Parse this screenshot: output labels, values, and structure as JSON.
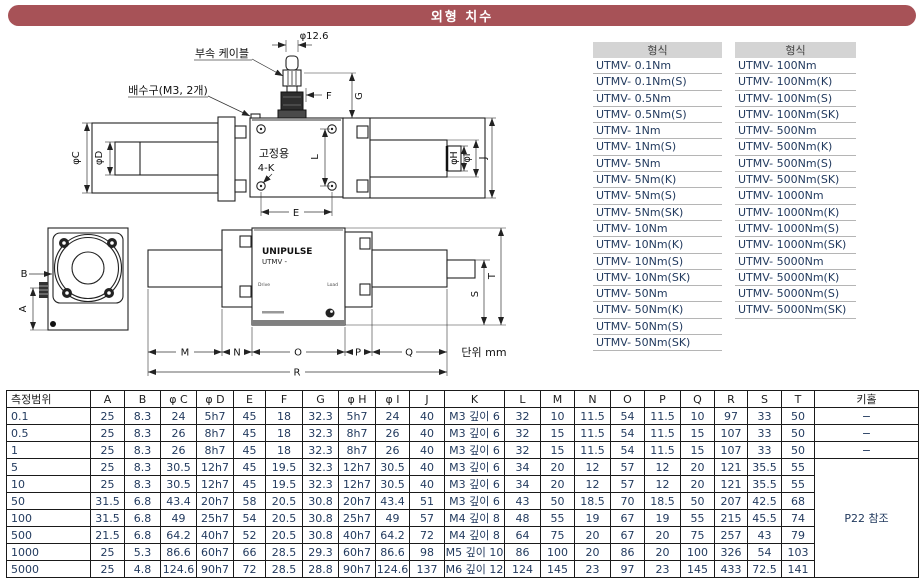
{
  "title": "외형 치수",
  "diagram": {
    "labels": {
      "cable": "부속 케이블",
      "cable_dia": "φ12.6",
      "drain": "배수구(M3, 2개)",
      "fixing_l1": "고정용",
      "fixing_l2": "4-K",
      "unit": "단위 mm"
    },
    "device": {
      "brand": "UNIPULSE",
      "model": "UTMV -",
      "left_label": "Drive",
      "right_label": "Load"
    },
    "dims": {
      "a": "A",
      "b": "B",
      "phi_c": "φC",
      "phi_d": "φD",
      "e": "E",
      "f": "F",
      "g": "G",
      "phi_h": "φH",
      "phi_i": "φI",
      "j": "J",
      "l": "L",
      "m": "M",
      "n": "N",
      "o": "O",
      "p": "P",
      "q": "Q",
      "r": "R",
      "s": "S",
      "t": "T"
    }
  },
  "model_lists": [
    {
      "header": "형식",
      "items": [
        "UTMV- 0.1Nm",
        "UTMV- 0.1Nm(S)",
        "UTMV- 0.5Nm",
        "UTMV- 0.5Nm(S)",
        "UTMV- 1Nm",
        "UTMV- 1Nm(S)",
        "UTMV- 5Nm",
        "UTMV- 5Nm(K)",
        "UTMV- 5Nm(S)",
        "UTMV- 5Nm(SK)",
        "UTMV- 10Nm",
        "UTMV- 10Nm(K)",
        "UTMV- 10Nm(S)",
        "UTMV- 10Nm(SK)",
        "UTMV- 50Nm",
        "UTMV- 50Nm(K)",
        "UTMV- 50Nm(S)",
        "UTMV- 50Nm(SK)"
      ]
    },
    {
      "header": "형식",
      "items": [
        "UTMV- 100Nm",
        "UTMV- 100Nm(K)",
        "UTMV- 100Nm(S)",
        "UTMV- 100Nm(SK)",
        "UTMV- 500Nm",
        "UTMV- 500Nm(K)",
        "UTMV- 500Nm(S)",
        "UTMV- 500Nm(SK)",
        "UTMV- 1000Nm",
        "UTMV- 1000Nm(K)",
        "UTMV- 1000Nm(S)",
        "UTMV- 1000Nm(SK)",
        "UTMV- 5000Nm",
        "UTMV- 5000Nm(K)",
        "UTMV- 5000Nm(S)",
        "UTMV- 5000Nm(SK)"
      ]
    }
  ],
  "table": {
    "headers": [
      "측정범위",
      "A",
      "B",
      "φ C",
      "φ D",
      "E",
      "F",
      "G",
      "φ H",
      "φ I",
      "J",
      "K",
      "L",
      "M",
      "N",
      "O",
      "P",
      "Q",
      "R",
      "S",
      "T",
      "키홀"
    ],
    "rows": [
      {
        "range": "0.1",
        "values": [
          "25",
          "8.3",
          "24",
          "5h7",
          "45",
          "18",
          "32.3",
          "5h7",
          "24",
          "40",
          "M3 깊이 6",
          "32",
          "10",
          "11.5",
          "54",
          "11.5",
          "10",
          "97",
          "33",
          "50"
        ],
        "keyhole": "−"
      },
      {
        "range": "0.5",
        "values": [
          "25",
          "8.3",
          "26",
          "8h7",
          "45",
          "18",
          "32.3",
          "8h7",
          "26",
          "40",
          "M3 깊이 6",
          "32",
          "15",
          "11.5",
          "54",
          "11.5",
          "15",
          "107",
          "33",
          "50"
        ],
        "keyhole": "−"
      },
      {
        "range": "1",
        "values": [
          "25",
          "8.3",
          "26",
          "8h7",
          "45",
          "18",
          "32.3",
          "8h7",
          "26",
          "40",
          "M3 깊이 6",
          "32",
          "15",
          "11.5",
          "54",
          "11.5",
          "15",
          "107",
          "33",
          "50"
        ],
        "keyhole": "−"
      },
      {
        "range": "5",
        "values": [
          "25",
          "8.3",
          "30.5",
          "12h7",
          "45",
          "19.5",
          "32.3",
          "12h7",
          "30.5",
          "40",
          "M3 깊이 6",
          "34",
          "20",
          "12",
          "57",
          "12",
          "20",
          "121",
          "35.5",
          "55"
        ],
        "keyhole": null
      },
      {
        "range": "10",
        "values": [
          "25",
          "8.3",
          "30.5",
          "12h7",
          "45",
          "19.5",
          "32.3",
          "12h7",
          "30.5",
          "40",
          "M3 깊이 6",
          "34",
          "20",
          "12",
          "57",
          "12",
          "20",
          "121",
          "35.5",
          "55"
        ],
        "keyhole": null
      },
      {
        "range": "50",
        "values": [
          "31.5",
          "6.8",
          "43.4",
          "20h7",
          "58",
          "20.5",
          "30.8",
          "20h7",
          "43.4",
          "51",
          "M3 깊이 6",
          "43",
          "50",
          "18.5",
          "70",
          "18.5",
          "50",
          "207",
          "42.5",
          "68"
        ],
        "keyhole": null
      },
      {
        "range": "100",
        "values": [
          "31.5",
          "6.8",
          "49",
          "25h7",
          "54",
          "20.5",
          "30.8",
          "25h7",
          "49",
          "57",
          "M4 깊이 8",
          "48",
          "55",
          "19",
          "67",
          "19",
          "55",
          "215",
          "45.5",
          "74"
        ],
        "keyhole": null
      },
      {
        "range": "500",
        "values": [
          "21.5",
          "6.8",
          "64.2",
          "40h7",
          "52",
          "20.5",
          "30.8",
          "40h7",
          "64.2",
          "72",
          "M4 깊이 8",
          "64",
          "75",
          "20",
          "67",
          "20",
          "75",
          "257",
          "43",
          "79"
        ],
        "keyhole": null
      },
      {
        "range": "1000",
        "values": [
          "25",
          "5.3",
          "86.6",
          "60h7",
          "66",
          "28.5",
          "29.3",
          "60h7",
          "86.6",
          "98",
          "M5 깊이 10",
          "86",
          "100",
          "20",
          "86",
          "20",
          "100",
          "326",
          "54",
          "103"
        ],
        "keyhole": null
      },
      {
        "range": "5000",
        "values": [
          "25",
          "4.8",
          "124.6",
          "90h7",
          "72",
          "28.5",
          "28.8",
          "90h7",
          "124.6",
          "137",
          "M6 깊이 12",
          "124",
          "145",
          "23",
          "97",
          "23",
          "145",
          "433",
          "72.5",
          "141"
        ],
        "keyhole": null
      }
    ],
    "keyhole_note": "P22 참조",
    "keyhole_note_rows": 7
  }
}
